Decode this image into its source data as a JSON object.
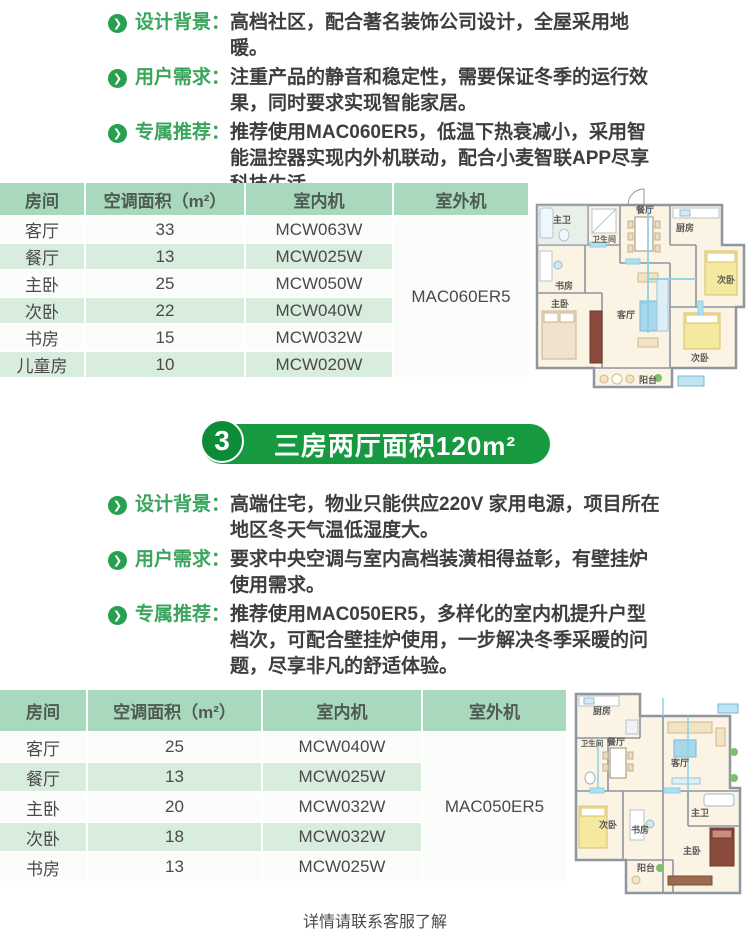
{
  "top": {
    "bullets": [
      {
        "label": "设计背景：",
        "text": "高档社区，配合著名装饰公司设计，全屋采用地暖。"
      },
      {
        "label": "用户需求：",
        "text": "注重产品的静音和稳定性，需要保证冬季的运行效果，同时要求实现智能家居。"
      },
      {
        "label": "专属推荐：",
        "text": "推荐使用MAC060ER5，低温下热衰减小，采用智能温控器实现内外机联动，配合小麦智联APP尽享科技生活。"
      }
    ],
    "table": {
      "headers": [
        "房间",
        "空调面积（m²）",
        "室内机",
        "室外机"
      ],
      "rows": [
        [
          "客厅",
          "33",
          "MCW063W"
        ],
        [
          "餐厅",
          "13",
          "MCW025W"
        ],
        [
          "主卧",
          "25",
          "MCW050W"
        ],
        [
          "次卧",
          "22",
          "MCW040W"
        ],
        [
          "书房",
          "15",
          "MCW032W"
        ],
        [
          "儿童房",
          "10",
          "MCW020W"
        ]
      ],
      "outdoor_unit": "MAC060ER5"
    },
    "floorplan_rooms": [
      "主卫",
      "卫生间",
      "餐厅",
      "厨房",
      "次卧",
      "书房",
      "主卧",
      "客厅",
      "次卧",
      "阳台"
    ]
  },
  "case3": {
    "badge": {
      "number": "3",
      "title": "三房两厅面积120m²"
    },
    "bullets": [
      {
        "label": "设计背景：",
        "text": "高端住宅，物业只能供应220V 家用电源，项目所在地区冬天气温低湿度大。"
      },
      {
        "label": "用户需求：",
        "text": "要求中央空调与室内高档装潢相得益彰，有壁挂炉使用需求。"
      },
      {
        "label": "专属推荐：",
        "text": "推荐使用MAC050ER5，多样化的室内机提升户型档次，可配合壁挂炉使用，一步解决冬季采暖的问题，尽享非凡的舒适体验。"
      }
    ],
    "table": {
      "headers": [
        "房间",
        "空调面积（m²）",
        "室内机",
        "室外机"
      ],
      "rows": [
        [
          "客厅",
          "25",
          "MCW040W"
        ],
        [
          "餐厅",
          "13",
          "MCW025W"
        ],
        [
          "主卧",
          "20",
          "MCW032W"
        ],
        [
          "次卧",
          "18",
          "MCW032W"
        ],
        [
          "书房",
          "13",
          "MCW025W"
        ]
      ],
      "outdoor_unit": "MAC050ER5"
    },
    "floorplan_rooms": [
      "厨房",
      "餐厅",
      "客厅",
      "卫生间",
      "次卧",
      "书房",
      "主卫",
      "主卧",
      "阳台"
    ]
  },
  "footer": {
    "text": "详情请联系客服了解"
  },
  "icons": {
    "bullet_arrow": "❯"
  },
  "colors": {
    "accent_green": "#17993f",
    "label_green": "#3aa55b",
    "table_header_green": "#a9d9bc",
    "table_row_green": "#d8edde"
  }
}
